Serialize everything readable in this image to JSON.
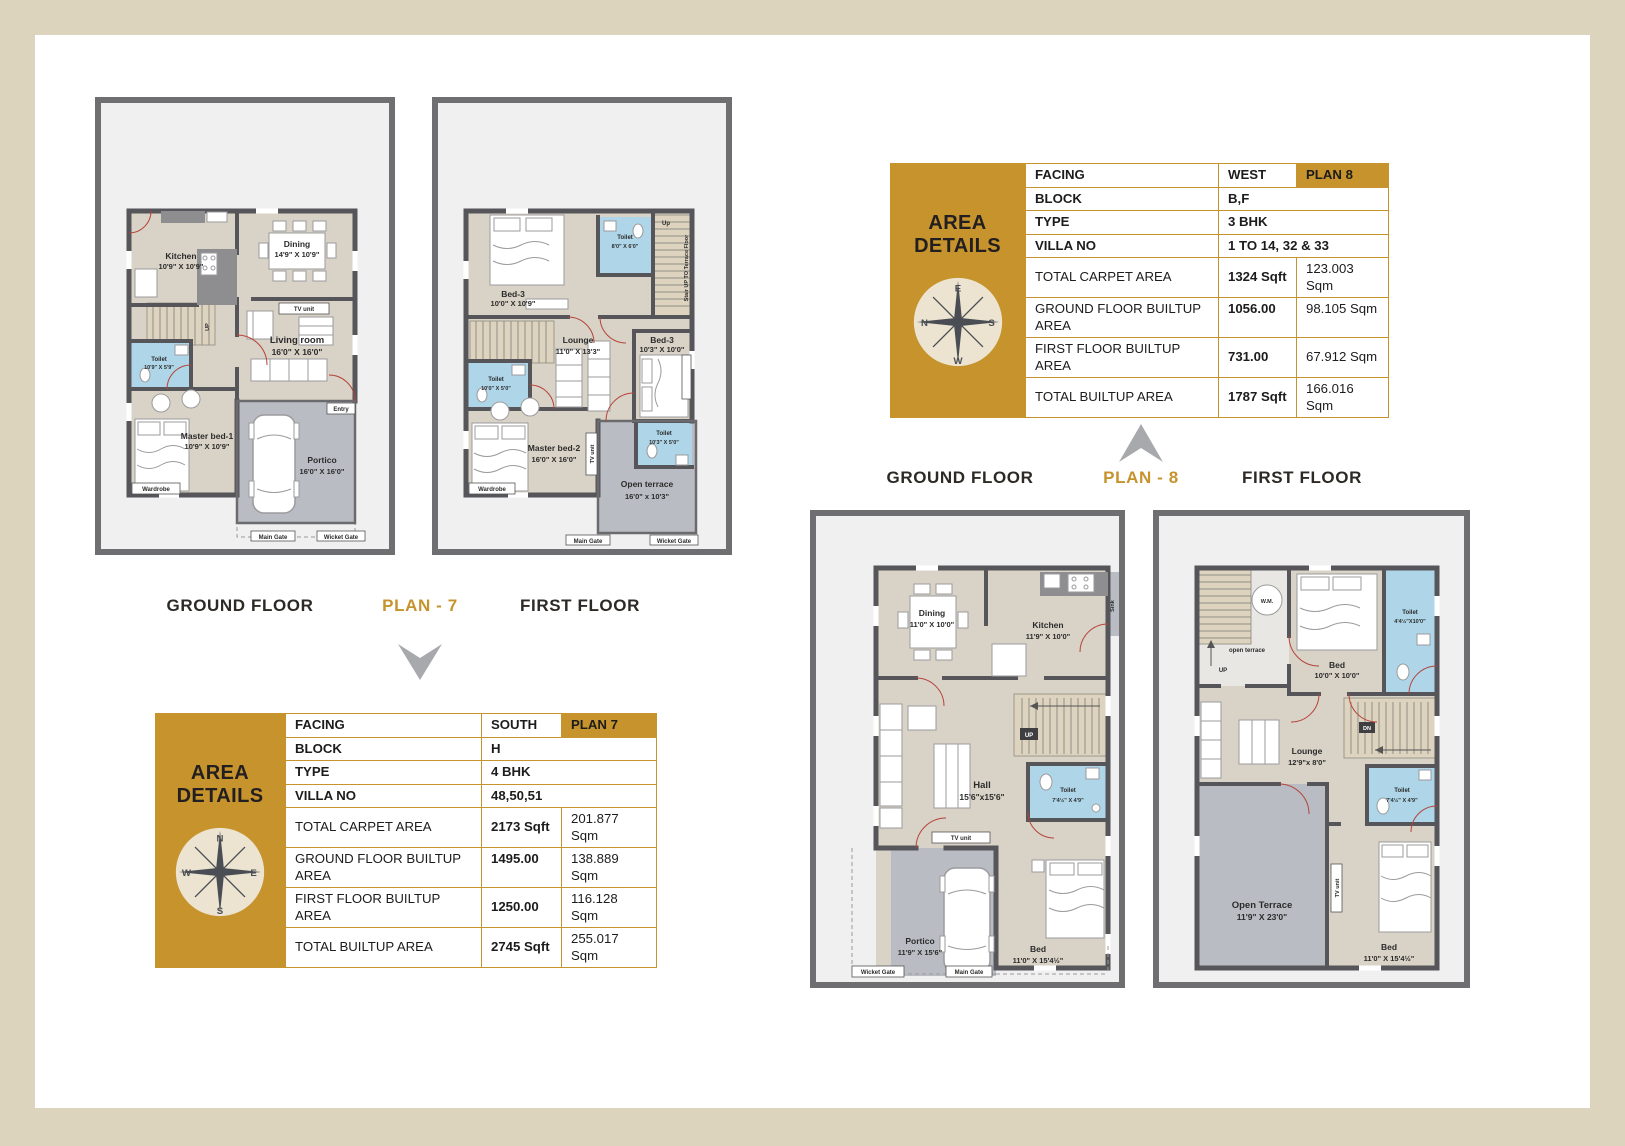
{
  "colors": {
    "gold": "#c6932c",
    "frame_beige": "#ddd4bd",
    "toilet_blue": "#aed6e8",
    "wall_gray": "#55555a"
  },
  "headings": {
    "p7_ground": "GROUND FLOOR",
    "p7_plan": "PLAN - 7",
    "p7_first": "FIRST FLOOR",
    "p8_ground": "GROUND FLOOR",
    "p8_plan": "PLAN - 8",
    "p8_first": "FIRST FLOOR"
  },
  "area_title": "AREA DETAILS",
  "t7": {
    "facing_l": "FACING",
    "facing_v": "SOUTH",
    "badge": "PLAN 7",
    "block_l": "BLOCK",
    "block_v": "H",
    "type_l": "TYPE",
    "type_v": "4 BHK",
    "villa_l": "VILLA NO",
    "villa_v": "48,50,51",
    "rows": [
      {
        "label": "TOTAL CARPET AREA",
        "sqft": "2173 Sqft",
        "sqm": "201.877 Sqm"
      },
      {
        "label": "GROUND FLOOR BUILTUP AREA",
        "sqft": "1495.00",
        "sqm": "138.889 Sqm"
      },
      {
        "label": "FIRST FLOOR BUILTUP AREA",
        "sqft": "1250.00",
        "sqm": "116.128 Sqm"
      },
      {
        "label": "TOTAL BUILTUP AREA",
        "sqft": "2745 Sqft",
        "sqm": "255.017 Sqm"
      }
    ]
  },
  "t8": {
    "facing_l": "FACING",
    "facing_v": "WEST",
    "badge": "PLAN 8",
    "block_l": "BLOCK",
    "block_v": "B,F",
    "type_l": "TYPE",
    "type_v": "3 BHK",
    "villa_l": "VILLA NO",
    "villa_v": "1 TO 14, 32 & 33",
    "rows": [
      {
        "label": "TOTAL CARPET AREA",
        "sqft": "1324 Sqft",
        "sqm": "123.003 Sqm"
      },
      {
        "label": "GROUND FLOOR BUILTUP AREA",
        "sqft": "1056.00",
        "sqm": "98.105 Sqm"
      },
      {
        "label": "FIRST FLOOR BUILTUP AREA",
        "sqft": "731.00",
        "sqm": "67.912 Sqm"
      },
      {
        "label": "TOTAL BUILTUP AREA",
        "sqft": "1787 Sqft",
        "sqm": "166.016 Sqm"
      }
    ]
  },
  "compass7": {
    "top": "N",
    "right": "E",
    "bottom": "S",
    "left": "W"
  },
  "compass8": {
    "top": "E",
    "right": "S",
    "bottom": "W",
    "left": "N"
  },
  "p7gf": {
    "kitchen_n": "Kitchen",
    "kitchen_d": "10'9\" X 10'9\"",
    "dining_n": "Dining",
    "dining_d": "14'9\" X 10'9\"",
    "living_n": "Living room",
    "living_d": "16'0\" X 16'0\"",
    "tv": "TV unit",
    "toilet_n": "Toilet",
    "toilet_d": "10'9\" X 5'9\"",
    "master_n": "Master bed-1",
    "master_d": "10'9\" X 10'9\"",
    "portico_n": "Portico",
    "portico_d": "16'0\" X 16'0\"",
    "entry": "Entry",
    "wardrobe": "Wardrobe",
    "up": "UP",
    "main_gate": "Main Gate",
    "wicket_gate": "Wicket Gate"
  },
  "p7ff": {
    "bed3a_n": "Bed-3",
    "bed3a_d": "10'0\" X 10'9\"",
    "toilet1_n": "Toilet",
    "toilet1_d": "8'0\" X 6'0\"",
    "up": "Up",
    "stair_note": "Stair UP TO Terrace Floor",
    "lounge_n": "Lounge",
    "lounge_d": "11'0\" X 13'3\"",
    "bed3b_n": "Bed-3",
    "bed3b_d": "10'3\" X 10'0\"",
    "toilet2_n": "Toilet",
    "toilet2_d": "10'0\" X 5'0\"",
    "master_n": "Master bed-2",
    "master_d": "16'0\" X 16'0\"",
    "toilet3_n": "Toilet",
    "toilet3_d": "10'3\" X 5'0\"",
    "terrace_n": "Open terrace",
    "terrace_d": "16'0\" x 10'3\"",
    "wardrobe": "Wardrobe",
    "tv": "TV unit",
    "main_gate": "Main Gate",
    "wicket_gate": "Wicket Gate"
  },
  "p8gf": {
    "dining_n": "Dining",
    "dining_d": "11'0\" X 10'0\"",
    "kitchen_n": "Kitchen",
    "kitchen_d": "11'9\" X 10'0\"",
    "sink": "Sink",
    "hall_n": "Hall",
    "hall_d": "15'6\"x15'6\"",
    "toilet_n": "Toilet",
    "toilet_d": "7'4½\" X 4'9\"",
    "up": "UP",
    "tv": "TV unit",
    "bed_n": "Bed",
    "bed_d": "11'0\" X 15'4½\"",
    "portico_n": "Portico",
    "portico_d": "11'9\" X 15'6\"",
    "wicket_gate": "Wicket Gate",
    "main_gate": "Main Gate"
  },
  "p8ff": {
    "wm": "W.M.",
    "terrace_small": "open terrace",
    "up": "UP",
    "bed1_n": "Bed",
    "bed1_d": "10'0\" X 10'0\"",
    "toilet1_n": "Toilet",
    "toilet1_d": "4'4½\"X10'0\"",
    "lounge_n": "Lounge",
    "lounge_d": "12'9\"x 8'0\"",
    "dn": "DN",
    "toilet2_n": "Toilet",
    "toilet2_d": "7'4½\" X 4'9\"",
    "tv": "TV unit",
    "terrace_n": "Open Terrace",
    "terrace_d": "11'9\" X 23'0\"",
    "bed2_n": "Bed",
    "bed2_d": "11'0\" X 15'4½\""
  }
}
